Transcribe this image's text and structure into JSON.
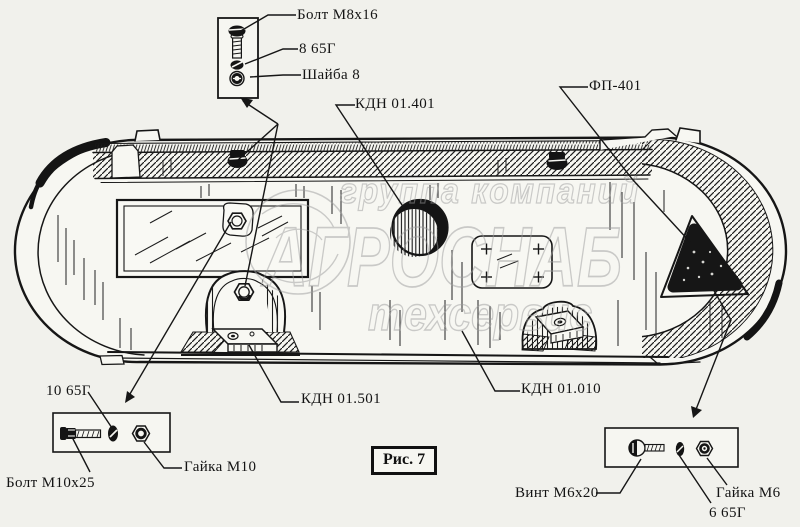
{
  "figure": {
    "caption": "Рис. 7"
  },
  "watermark": {
    "line1": "группа компаний",
    "line2": "АГРОСНАБ",
    "line3": "техсервис"
  },
  "labels": {
    "bolt_m8": "Болт М8х16",
    "spring_washer_8": "8 65Г",
    "washer_8": "Шайба 8",
    "kdn_01_401": "КДН 01.401",
    "fp_401": "ФП-401",
    "spring_washer_10": "10 65Г",
    "bolt_m10": "Болт М10х25",
    "nut_m10": "Гайка М10",
    "kdn_01_501": "КДН 01.501",
    "kdn_01_010": "КДН 01.010",
    "screw_m6": "Винт М6х20",
    "nut_m6": "Гайка М6",
    "spring_washer_6": "6 65Г"
  },
  "colors": {
    "line": "#161616",
    "background": "#f1f1ec",
    "panel_face": "#f7f7f2",
    "watermark": "#9d9d9d"
  }
}
